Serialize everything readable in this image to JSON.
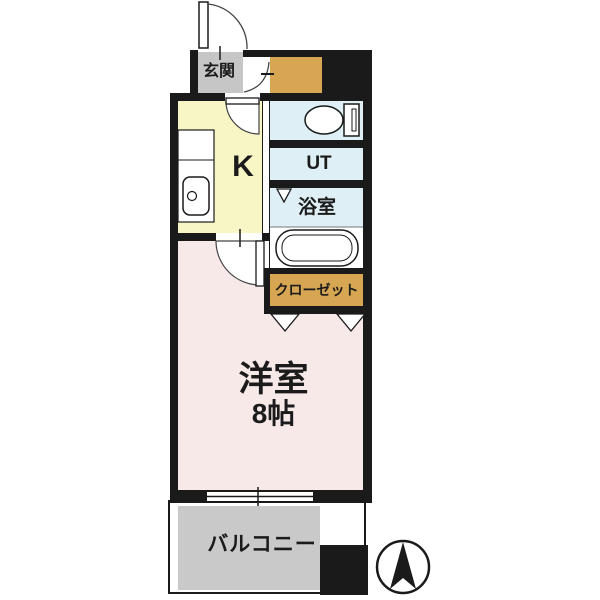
{
  "title": "1K apartment floor plan",
  "colors": {
    "wall": "#1a1a1a",
    "kitchen": "#f9f6c5",
    "entrance": "#c6c6c6",
    "storage": "#d7a652",
    "wet_area": "#def0f6",
    "main_room": "#f8e9e9",
    "balcony": "#c9c9c9"
  },
  "rooms": {
    "entrance": {
      "label": "玄関"
    },
    "kitchen": {
      "label": "K"
    },
    "utility": {
      "label": "UT"
    },
    "bathroom": {
      "label": "浴室"
    },
    "closet": {
      "label": "クローゼット"
    },
    "main_room": {
      "label": "洋室",
      "size_label": "8帖"
    },
    "balcony": {
      "label": "バルコニー"
    }
  },
  "fixtures": {
    "toilet": "toilet-icon",
    "bathtub": "bathtub-icon",
    "kitchen_sink": "kitchen-sink-icon",
    "compass": "north-arrow-icon"
  }
}
